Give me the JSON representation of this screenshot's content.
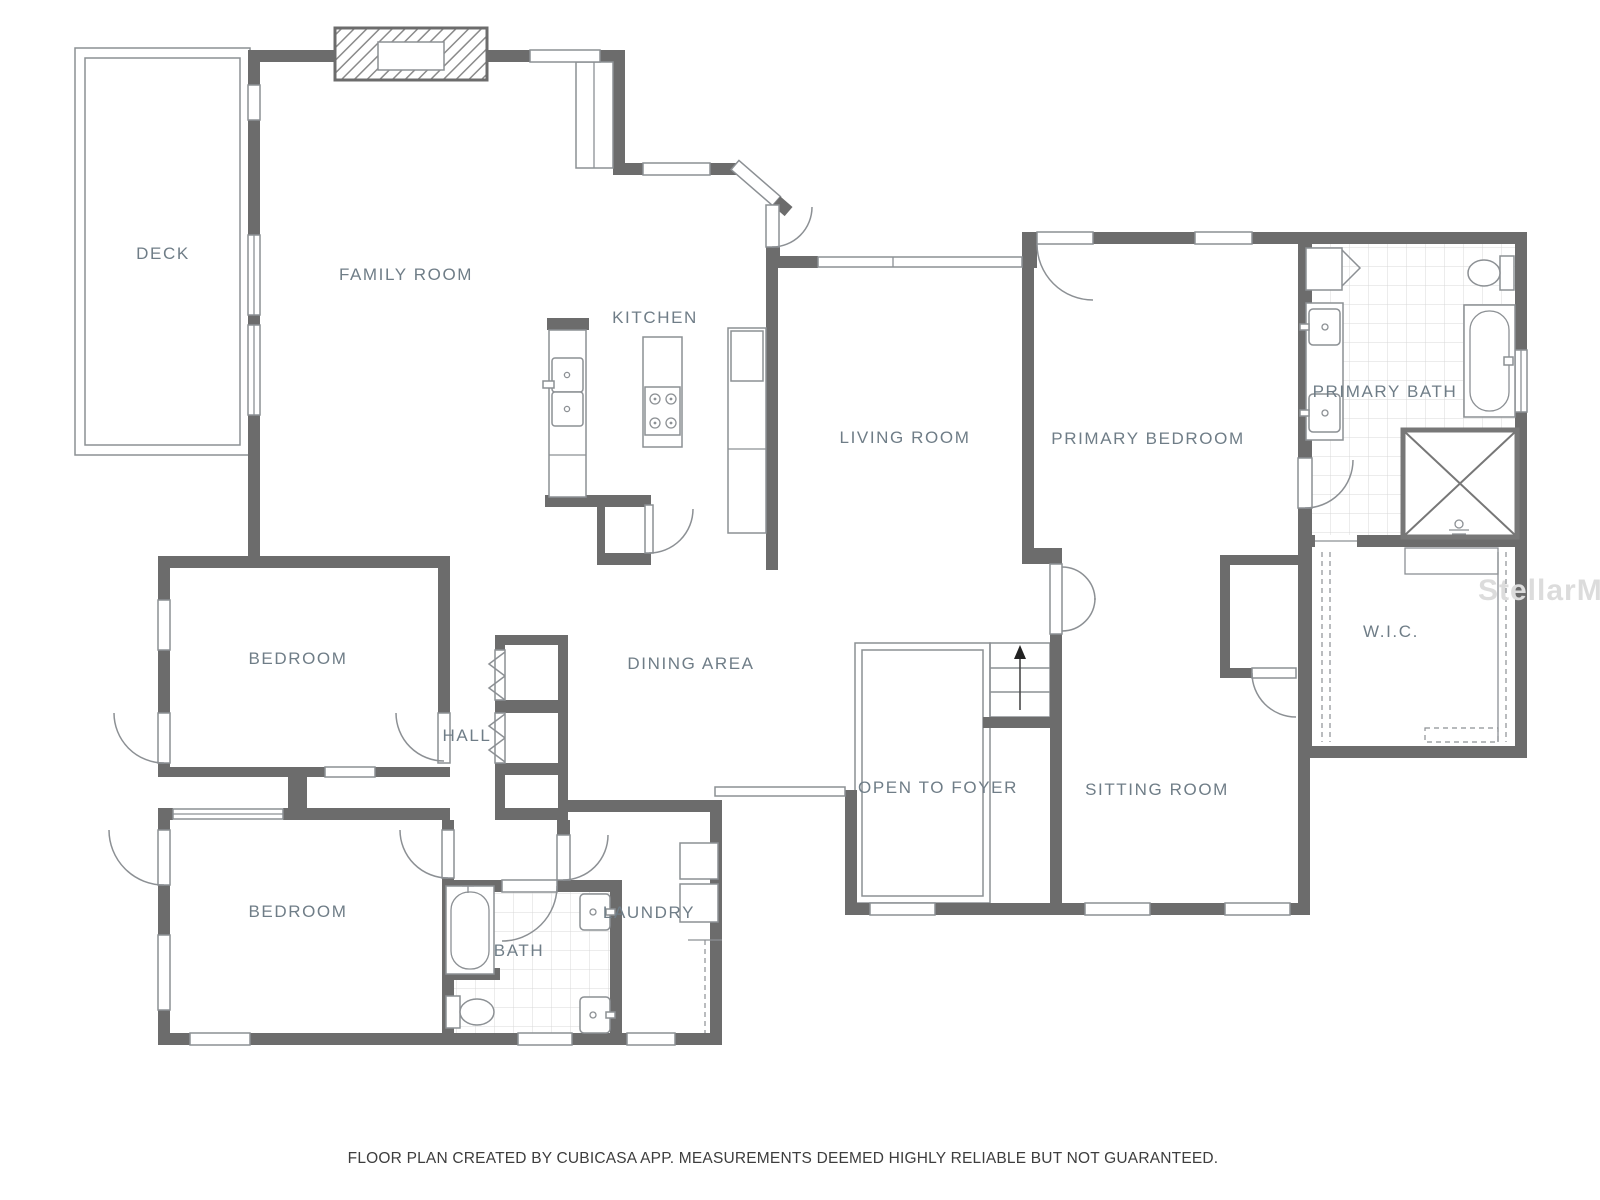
{
  "floor_plan": {
    "rooms": {
      "deck": {
        "label": "DECK"
      },
      "family_room": {
        "label": "FAMILY ROOM"
      },
      "kitchen": {
        "label": "KITCHEN"
      },
      "living_room": {
        "label": "LIVING ROOM"
      },
      "primary_bedroom": {
        "label": "PRIMARY BEDROOM"
      },
      "primary_bath": {
        "label": "PRIMARY BATH"
      },
      "wic": {
        "label": "W.I.C."
      },
      "bedroom_upper": {
        "label": "BEDROOM"
      },
      "hall": {
        "label": "HALL"
      },
      "dining_area": {
        "label": "DINING AREA"
      },
      "open_to_foyer": {
        "label": "OPEN TO FOYER"
      },
      "sitting_room": {
        "label": "SITTING ROOM"
      },
      "bedroom_lower": {
        "label": "BEDROOM"
      },
      "bath": {
        "label": "BATH"
      },
      "laundry": {
        "label": "LAUNDRY"
      }
    },
    "footer": {
      "text": "FLOOR PLAN CREATED BY CUBICASA APP. MEASUREMENTS DEEMED HIGHLY RELIABLE BUT NOT GUARANTEED."
    },
    "watermark": {
      "text": "StellarMLS"
    },
    "colors": {
      "wall": "#6c6c6c",
      "thin": "#8c9094",
      "label": "#6f7d87",
      "tile": "#d8d8d8",
      "footer": "#3d3d3d",
      "watermark": "#dcdcdc",
      "paper": "#ffffff"
    }
  }
}
